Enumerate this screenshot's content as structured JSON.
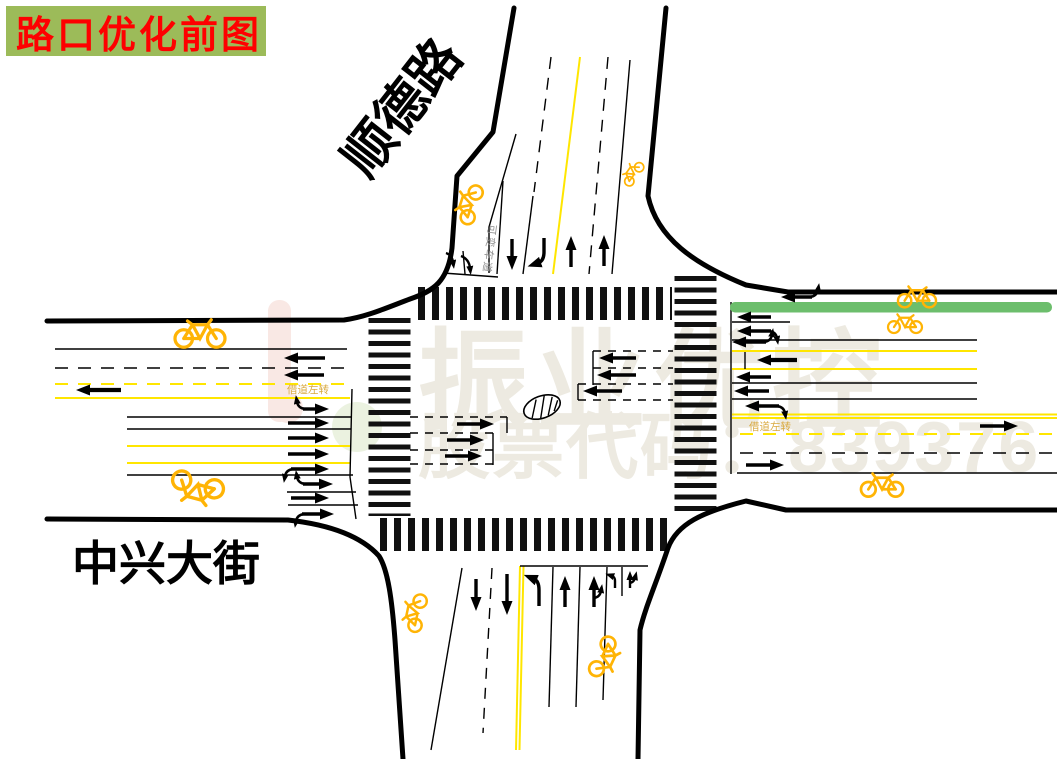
{
  "title": {
    "text": "路口优化前图"
  },
  "roads": {
    "north_label": "顺德路",
    "west_label": "中兴大街"
  },
  "markings": {
    "variable_lane": "可变车道",
    "borrow_left_west": "借道左转",
    "borrow_left_east": "借道左转"
  },
  "watermark": {
    "line1": "振业优控",
    "line2": "股票代码：839376"
  },
  "colors": {
    "title_bg": "#9CBB59",
    "title_text": "#FE0000",
    "lane_yellow": "#FFE600",
    "bicycle_yellow": "#FFB405",
    "bus_lane_green": "#6CBE6C",
    "gold_text": "#D9A93F",
    "watermark_gray": "#EDEAE1",
    "road_black": "#000000"
  },
  "icons": [
    {
      "name": "bicycle-icon",
      "meaning": "non-motorized (bicycle) lane marking",
      "color": "#FFB405",
      "glyph": "two circles + frame lines"
    },
    {
      "name": "center-island-icon",
      "meaning": "hatched central island ellipse",
      "glyph": "ellipse with diagonal hatching"
    }
  ]
}
